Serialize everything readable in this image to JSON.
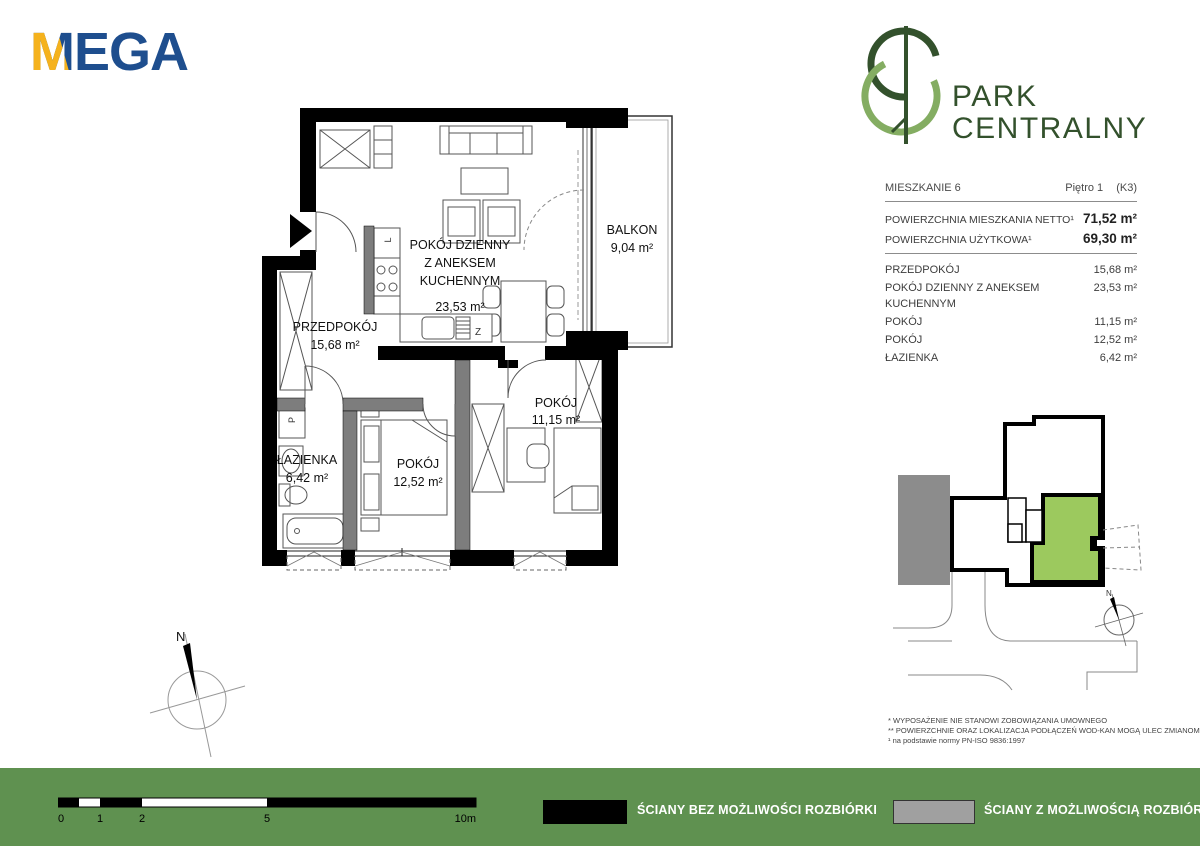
{
  "brand": {
    "mega": "MEGA",
    "park_line1": "PARK",
    "park_line2": "CENTRALNY"
  },
  "info": {
    "unit": "MIESZKANIE 6",
    "floor": "Piętro 1",
    "block": "(K3)",
    "netto_label": "POWIERZCHNIA MIESZKANIA NETTO¹",
    "netto_value": "71,52 m²",
    "uzytkowa_label": "POWIERZCHNIA UŻYTKOWA¹",
    "uzytkowa_value": "69,30 m²",
    "rooms": [
      {
        "name": "PRZEDPOKÓJ",
        "area": "15,68 m²"
      },
      {
        "name": "POKÓJ DZIENNY Z ANEKSEM KUCHENNYM",
        "area": "23,53 m²"
      },
      {
        "name": "POKÓJ",
        "area": "11,15 m²"
      },
      {
        "name": "POKÓJ",
        "area": "12,52 m²"
      },
      {
        "name": "ŁAZIENKA",
        "area": "6,42 m²"
      }
    ]
  },
  "plan": {
    "living": {
      "l1": "POKÓJ DZIENNY",
      "l2": "Z ANEKSEM",
      "l3": "KUCHENNYM",
      "area": "23,53 m²"
    },
    "balkon": {
      "name": "BALKON",
      "area": "9,04 m²"
    },
    "hall": {
      "name": "PRZEDPOKÓJ",
      "area": "15,68 m²"
    },
    "bath": {
      "name": "ŁAZIENKA",
      "area": "6,42 m²"
    },
    "room_small": {
      "name": "POKÓJ",
      "area": "11,15 m²"
    },
    "room_big": {
      "name": "POKÓJ",
      "area": "12,52 m²"
    },
    "symbols": {
      "fridge": "L",
      "dishwasher": "Z",
      "washer": "P"
    }
  },
  "compass": {
    "north": "N"
  },
  "footnotes": {
    "f1": "*  WYPOSAŻENIE NIE STANOWI ZOBOWIĄZANIA UMOWNEGO",
    "f2": "** POWIERZCHNIE ORAZ LOKALIZACJA PODŁĄCZEŃ WOD-KAN MOGĄ ULEC ZMIANOM",
    "f3": "¹ na podstawie normy PN-ISO 9836:1997"
  },
  "footer": {
    "legend_no_demolition": "ŚCIANY BEZ MOŻLIWOŚCI ROZBIÓRKI",
    "legend_demolition": "ŚCIANY Z MOŻLIWOŚCIĄ ROZBIÓRKI",
    "scale_ticks": [
      "0",
      "1",
      "2",
      "5",
      "10m"
    ]
  },
  "colors": {
    "mega_navy": "#1e4e8e",
    "mega_yellow": "#f5b21d",
    "park_dark_green": "#33512c",
    "park_light_green": "#84ad62",
    "footer_green": "#5f9150",
    "unit_highlight_green": "#9cc95e",
    "wall_black": "#000000",
    "wall_gray": "#7d7d7d",
    "legend_gray": "#a0a0a0"
  }
}
